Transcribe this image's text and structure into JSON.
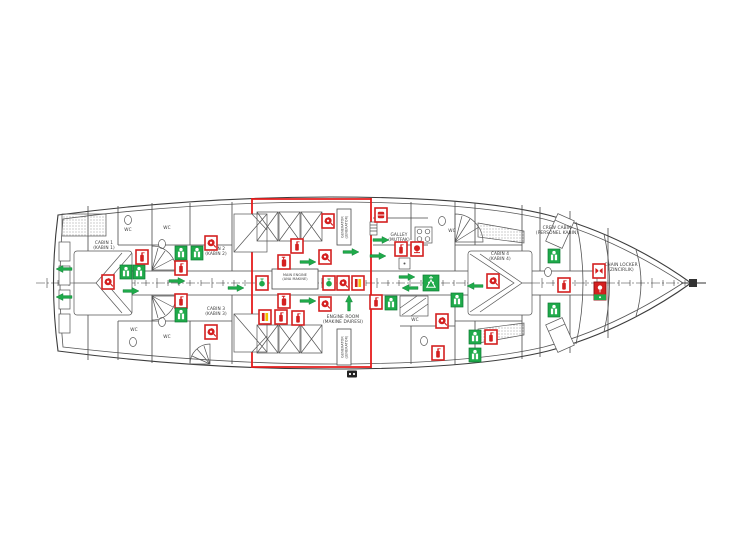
{
  "document": {
    "type": "ship-safety-plan-deck-drawing",
    "background": "#ffffff"
  },
  "colors": {
    "safety_red": "#d42020",
    "safety_red_dark": "#8e1010",
    "safety_green": "#1faa4a",
    "safety_green_dark": "#0d7a32",
    "accent_yellow": "#f2c200",
    "bulkhead_red": "#e51c1c",
    "line_gray": "#3c3c3c"
  },
  "centerline": {
    "y": 283,
    "x_start": 36,
    "x_end": 706,
    "tick_from": 47,
    "tick_to": 688,
    "tick_step": 11
  },
  "rooms": [
    {
      "id": "cabin-1",
      "lines": [
        "CABIN 1",
        "(KABIN 1)"
      ],
      "x": 104,
      "y": 244
    },
    {
      "id": "wc-1",
      "lines": [
        "WC"
      ],
      "x": 128,
      "y": 231
    },
    {
      "id": "wc-2",
      "lines": [
        "WC"
      ],
      "x": 167,
      "y": 229
    },
    {
      "id": "cabin-2",
      "lines": [
        "CABIN 2",
        "(KABIN 2)"
      ],
      "x": 216,
      "y": 250
    },
    {
      "id": "cabin-3",
      "lines": [
        "CABIN 3",
        "(KABIN 3)"
      ],
      "x": 216,
      "y": 310
    },
    {
      "id": "wc-3",
      "lines": [
        "WC"
      ],
      "x": 134,
      "y": 331
    },
    {
      "id": "wc-4",
      "lines": [
        "WC"
      ],
      "x": 167,
      "y": 338
    },
    {
      "id": "main-engine",
      "lines": [
        "MAIN ENGINE",
        "(ANA MAKINE)"
      ],
      "x": 295,
      "y": 276,
      "small": true,
      "boxed": {
        "x": 272,
        "y": 269,
        "w": 46,
        "h": 20
      }
    },
    {
      "id": "generator-1",
      "lines": [
        "GENERATOR",
        "(JENERATOR)"
      ],
      "x": 344,
      "y": 227,
      "small": true,
      "vertical": true,
      "boxed": {
        "x": 337,
        "y": 209,
        "w": 14,
        "h": 36
      }
    },
    {
      "id": "generator-2",
      "lines": [
        "GENERATOR",
        "(JENERATOR)"
      ],
      "x": 344,
      "y": 347,
      "small": true,
      "vertical": true,
      "boxed": {
        "x": 337,
        "y": 329,
        "w": 14,
        "h": 36
      }
    },
    {
      "id": "engine-room",
      "lines": [
        "ENGINE ROOM",
        "(MAKINE DAIRESI)"
      ],
      "x": 343,
      "y": 318
    },
    {
      "id": "galley",
      "lines": [
        "GALLEY",
        "(MUTFAK)"
      ],
      "x": 399,
      "y": 236
    },
    {
      "id": "wc-5",
      "lines": [
        "WC"
      ],
      "x": 452,
      "y": 232
    },
    {
      "id": "wc-6",
      "lines": [
        "WC"
      ],
      "x": 415,
      "y": 321
    },
    {
      "id": "cabin-4",
      "lines": [
        "CABIN 4",
        "(KABIN 4)"
      ],
      "x": 500,
      "y": 255
    },
    {
      "id": "crew-cabin",
      "lines": [
        "CREW CABIN",
        "(PERSONEL KABIN)"
      ],
      "x": 557,
      "y": 229
    },
    {
      "id": "chain-locker",
      "lines": [
        "CHAIN LOCKER",
        "(ZINCIRLIK)"
      ],
      "x": 621,
      "y": 266
    }
  ],
  "symbol_legend": {
    "extinguisher": "fire-extinguisher",
    "co2": "co2-extinguisher-bottle",
    "lifejacket": "lifejacket",
    "hosereel": "fire-hose-reel",
    "arrow": "escape-route-arrow",
    "blanket": "fire-blanket",
    "bell": "fire-alarm-bell",
    "valve": "emergency-shutoff-valve",
    "foam": "foam-applicator",
    "assembly": "assembly-muster-station",
    "damper": "fire-damper",
    "eebd": "emergency-escape-breathing-device",
    "shore": "international-shore-connection"
  },
  "symbols": [
    {
      "t": "arrow",
      "x": 64,
      "y": 269,
      "d": "left"
    },
    {
      "t": "arrow",
      "x": 64,
      "y": 297,
      "d": "left"
    },
    {
      "t": "hosereel",
      "x": 108,
      "y": 282
    },
    {
      "t": "lifejacket",
      "x": 126,
      "y": 272
    },
    {
      "t": "lifejacket",
      "x": 139,
      "y": 272
    },
    {
      "t": "extinguisher",
      "x": 142,
      "y": 257
    },
    {
      "t": "arrow",
      "x": 131,
      "y": 291,
      "d": "right"
    },
    {
      "t": "lifejacket",
      "x": 181,
      "y": 253
    },
    {
      "t": "lifejacket",
      "x": 197,
      "y": 253
    },
    {
      "t": "extinguisher",
      "x": 181,
      "y": 268
    },
    {
      "t": "arrow",
      "x": 177,
      "y": 281,
      "d": "right"
    },
    {
      "t": "extinguisher",
      "x": 181,
      "y": 301
    },
    {
      "t": "lifejacket",
      "x": 181,
      "y": 315
    },
    {
      "t": "hosereel",
      "x": 211,
      "y": 243
    },
    {
      "t": "hosereel",
      "x": 211,
      "y": 332
    },
    {
      "t": "arrow",
      "x": 236,
      "y": 288,
      "d": "right"
    },
    {
      "t": "hosereel",
      "x": 328,
      "y": 221
    },
    {
      "t": "extinguisher",
      "x": 297,
      "y": 246
    },
    {
      "t": "co2",
      "x": 284,
      "y": 262
    },
    {
      "t": "arrow",
      "x": 308,
      "y": 262,
      "d": "right"
    },
    {
      "t": "hosereel",
      "x": 325,
      "y": 257
    },
    {
      "t": "arrow",
      "x": 351,
      "y": 252,
      "d": "right"
    },
    {
      "t": "valve",
      "x": 262,
      "y": 283
    },
    {
      "t": "valve",
      "x": 329,
      "y": 283
    },
    {
      "t": "hosereel",
      "x": 343,
      "y": 283
    },
    {
      "t": "foam",
      "x": 358,
      "y": 283
    },
    {
      "t": "co2",
      "x": 284,
      "y": 301
    },
    {
      "t": "arrow",
      "x": 308,
      "y": 301,
      "d": "right"
    },
    {
      "t": "hosereel",
      "x": 325,
      "y": 304
    },
    {
      "t": "arrow",
      "x": 349,
      "y": 303,
      "d": "up"
    },
    {
      "t": "foam",
      "x": 265,
      "y": 317
    },
    {
      "t": "extinguisher",
      "x": 281,
      "y": 317
    },
    {
      "t": "extinguisher",
      "x": 298,
      "y": 318
    },
    {
      "t": "blanket",
      "x": 381,
      "y": 215
    },
    {
      "t": "arrow",
      "x": 381,
      "y": 240,
      "d": "right"
    },
    {
      "t": "arrow",
      "x": 378,
      "y": 256,
      "d": "right"
    },
    {
      "t": "extinguisher",
      "x": 401,
      "y": 249
    },
    {
      "t": "bell",
      "x": 417,
      "y": 249
    },
    {
      "t": "extinguisher",
      "x": 376,
      "y": 302
    },
    {
      "t": "lifejacket",
      "x": 391,
      "y": 303
    },
    {
      "t": "assembly",
      "x": 431,
      "y": 283
    },
    {
      "t": "arrow",
      "x": 407,
      "y": 277,
      "d": "right"
    },
    {
      "t": "arrow",
      "x": 410,
      "y": 288,
      "d": "left"
    },
    {
      "t": "lifejacket",
      "x": 457,
      "y": 300
    },
    {
      "t": "hosereel",
      "x": 442,
      "y": 321
    },
    {
      "t": "lifejacket",
      "x": 475,
      "y": 337
    },
    {
      "t": "extinguisher",
      "x": 491,
      "y": 337
    },
    {
      "t": "extinguisher",
      "x": 438,
      "y": 353
    },
    {
      "t": "lifejacket",
      "x": 475,
      "y": 355
    },
    {
      "t": "arrow",
      "x": 475,
      "y": 286,
      "d": "left"
    },
    {
      "t": "hosereel",
      "x": 493,
      "y": 281
    },
    {
      "t": "lifejacket",
      "x": 554,
      "y": 256
    },
    {
      "t": "lifejacket",
      "x": 554,
      "y": 310
    },
    {
      "t": "extinguisher",
      "x": 564,
      "y": 285
    },
    {
      "t": "damper",
      "x": 599,
      "y": 271
    },
    {
      "t": "eebd",
      "x": 600,
      "y": 291
    },
    {
      "t": "shore",
      "x": 352,
      "y": 374
    }
  ]
}
